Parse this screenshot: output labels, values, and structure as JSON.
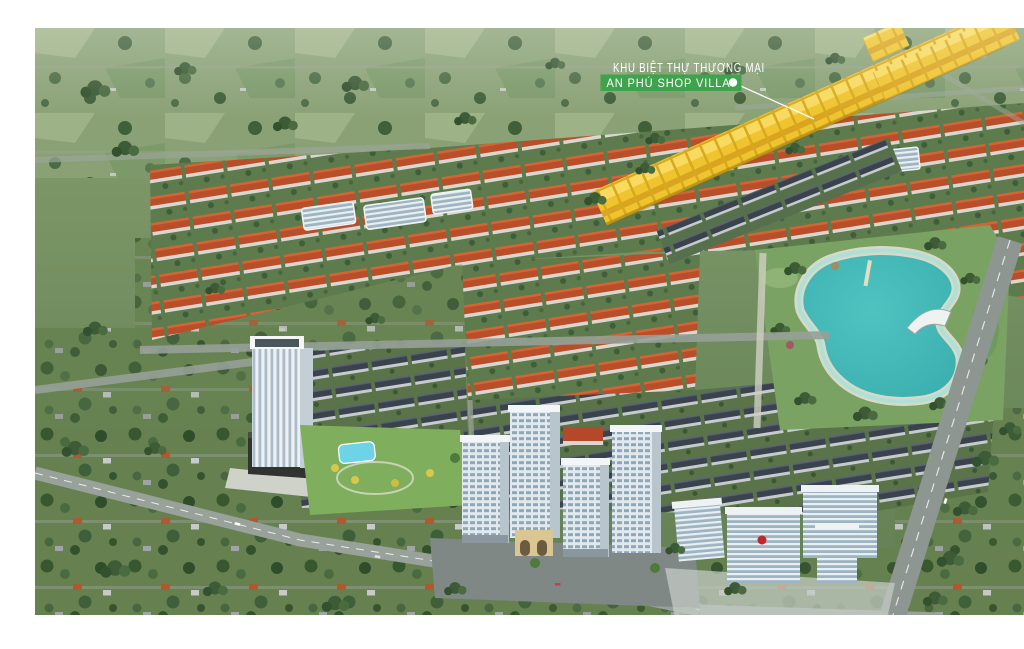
{
  "annotation": {
    "line1": "KHU BIỆT THỰ THƯƠNG MẠI",
    "line2": "AN PHÚ SHOP VILLA"
  },
  "palette": {
    "label_green": "#3ea34c",
    "leader_white": "#ffffff",
    "highlight_yellow": "#efc42f",
    "lake_teal": "#4ec3c0",
    "roof_red": "#b94e2a",
    "shophouse_roof": "#3a434d",
    "park_green": "#7aa263",
    "field_green": "#8aa176",
    "road_gray": "#99a19b",
    "tower_white": "#e3eaee"
  },
  "scene": {
    "features": [
      "yellow-highlighted-shop-villa-rows",
      "red-roof-townhouse-rows",
      "dark-roof-shophouse-rows",
      "kidney-shaped-lake-park",
      "white-apartment-towers",
      "office-tower-with-podium",
      "landscape-park-with-pool",
      "office-campus",
      "tree-lined-boulevards"
    ]
  }
}
